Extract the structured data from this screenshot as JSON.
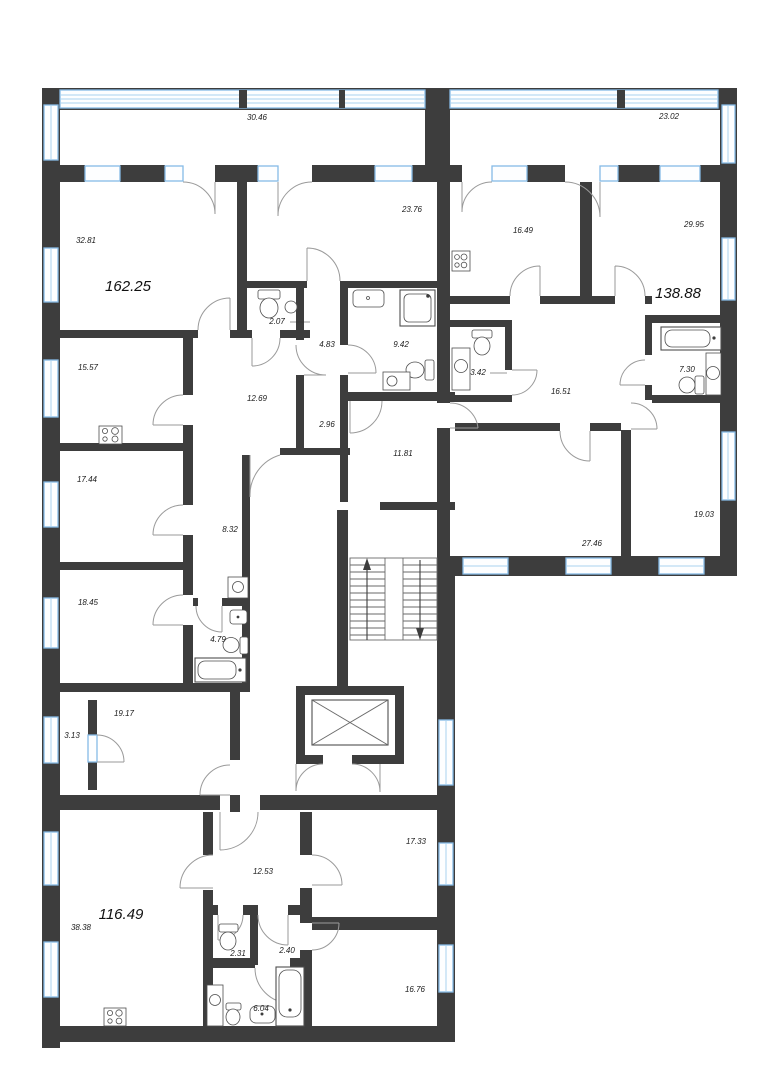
{
  "plan": {
    "title": "floor-plan",
    "colors": {
      "wall": "#3d3d3d",
      "window": "#85bbe6",
      "door_arc": "#9a9a9a",
      "background": "#ffffff",
      "label": "#1b1b1b"
    },
    "apartments": [
      {
        "id": "apt-162",
        "area": "162.25",
        "x": 128,
        "y": 291
      },
      {
        "id": "apt-138",
        "area": "138.88",
        "x": 678,
        "y": 298
      },
      {
        "id": "apt-116",
        "area": "116.49",
        "x": 121,
        "y": 919
      }
    ],
    "rooms": [
      {
        "id": "balcony-top-left",
        "area": "30.46",
        "x": 257,
        "y": 120
      },
      {
        "id": "balcony-top-right",
        "area": "23.02",
        "x": 669,
        "y": 119
      },
      {
        "id": "room-32-81",
        "area": "32.81",
        "x": 86,
        "y": 243
      },
      {
        "id": "room-23-76",
        "area": "23.76",
        "x": 412,
        "y": 212
      },
      {
        "id": "room-16-49",
        "area": "16.49",
        "x": 523,
        "y": 233
      },
      {
        "id": "room-29-95",
        "area": "29.95",
        "x": 694,
        "y": 227
      },
      {
        "id": "room-15-57",
        "area": "15.57",
        "x": 88,
        "y": 370
      },
      {
        "id": "wc-2-07",
        "area": "2.07",
        "x": 277,
        "y": 324
      },
      {
        "id": "corridor-4-83",
        "area": "4.83",
        "x": 327,
        "y": 347
      },
      {
        "id": "bath-9-42",
        "area": "9.42",
        "x": 401,
        "y": 347
      },
      {
        "id": "wc-3-42",
        "area": "3.42",
        "x": 478,
        "y": 375
      },
      {
        "id": "hall-16-51",
        "area": "16.51",
        "x": 561,
        "y": 394
      },
      {
        "id": "bath-7-30",
        "area": "7.30",
        "x": 687,
        "y": 372
      },
      {
        "id": "hall-12-69",
        "area": "12.69",
        "x": 257,
        "y": 401
      },
      {
        "id": "corridor-2-96",
        "area": "2.96",
        "x": 327,
        "y": 427
      },
      {
        "id": "corridor-11-81",
        "area": "11.81",
        "x": 403,
        "y": 456
      },
      {
        "id": "room-17-44",
        "area": "17.44",
        "x": 87,
        "y": 482
      },
      {
        "id": "corridor-8-32",
        "area": "8.32",
        "x": 230,
        "y": 532
      },
      {
        "id": "room-18-45",
        "area": "18.45",
        "x": 88,
        "y": 605
      },
      {
        "id": "bath-4-79",
        "area": "4.79",
        "x": 218,
        "y": 642
      },
      {
        "id": "room-27-46",
        "area": "27.46",
        "x": 592,
        "y": 546
      },
      {
        "id": "room-19-03",
        "area": "19.03",
        "x": 704,
        "y": 517
      },
      {
        "id": "room-19-17",
        "area": "19.17",
        "x": 124,
        "y": 716
      },
      {
        "id": "balcony-3-13",
        "area": "3.13",
        "x": 72,
        "y": 738
      },
      {
        "id": "room-38-38",
        "area": "38.38",
        "x": 81,
        "y": 930
      },
      {
        "id": "hall-12-53",
        "area": "12.53",
        "x": 263,
        "y": 874
      },
      {
        "id": "room-17-33",
        "area": "17.33",
        "x": 416,
        "y": 844
      },
      {
        "id": "wc-2-31",
        "area": "2.31",
        "x": 238,
        "y": 956
      },
      {
        "id": "corridor-2-40",
        "area": "2.40",
        "x": 287,
        "y": 953
      },
      {
        "id": "bath-6-04",
        "area": "6.04",
        "x": 261,
        "y": 1011
      },
      {
        "id": "room-16-76",
        "area": "16.76",
        "x": 415,
        "y": 992
      }
    ]
  }
}
